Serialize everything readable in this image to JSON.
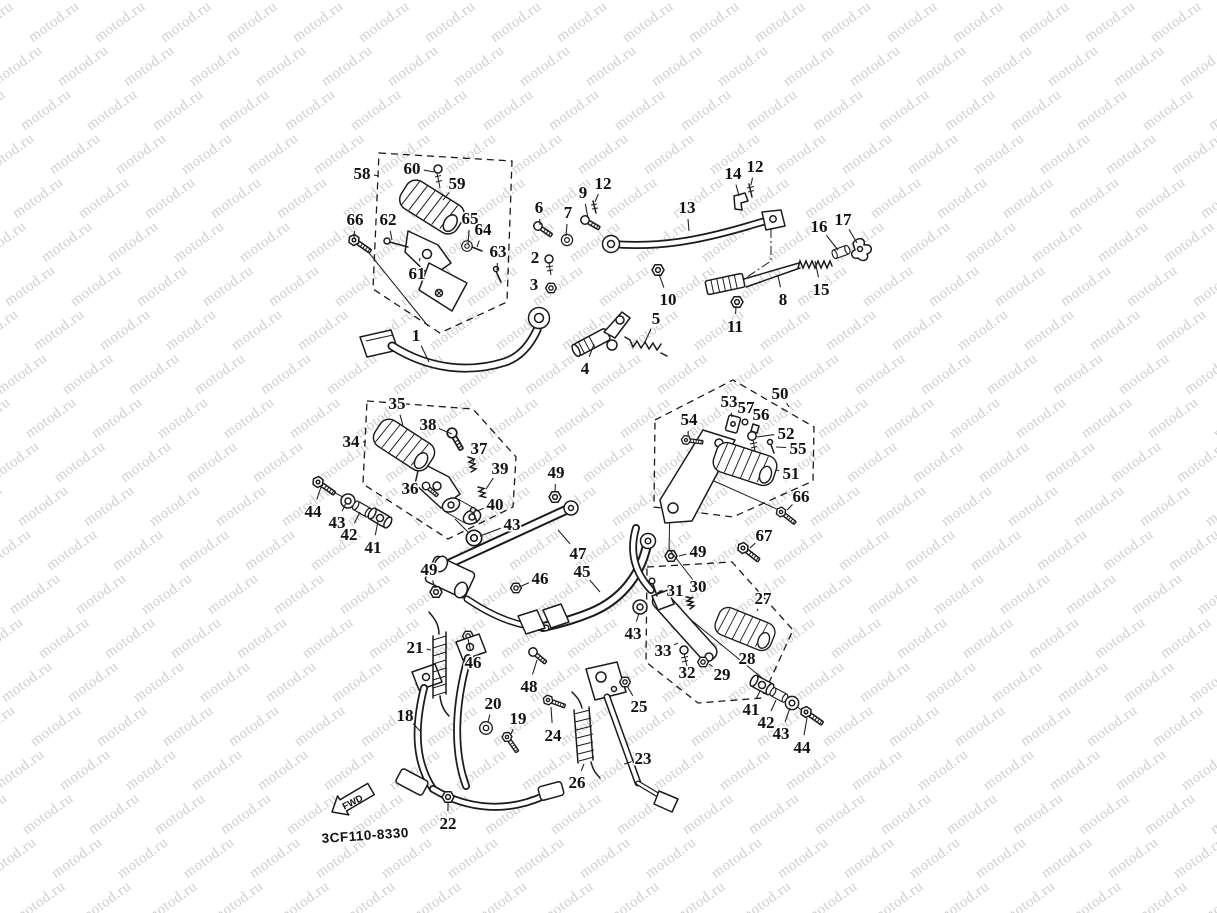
{
  "page": {
    "width": 1217,
    "height": 913,
    "background": "#ffffff"
  },
  "watermark": {
    "text": "motod.ru",
    "color": "#cfcfcf",
    "font_size_px": 15,
    "rotation_deg": -36,
    "col_step_px": 66,
    "row_step_px": 44,
    "row_drift_px": 29
  },
  "diagram": {
    "code": "3CF110-8330",
    "fwd_label": "FWD",
    "line_color": "#1b1b1b",
    "callouts": [
      {
        "label": "58",
        "x": 362,
        "y": 173,
        "tx": 379,
        "ty": 176
      },
      {
        "label": "60",
        "x": 412,
        "y": 168,
        "tx": 434,
        "ty": 172
      },
      {
        "label": "59",
        "x": 457,
        "y": 183,
        "tx": 443,
        "ty": 200
      },
      {
        "label": "66",
        "x": 355,
        "y": 219,
        "tx": 354,
        "ty": 238
      },
      {
        "label": "62",
        "x": 388,
        "y": 219,
        "tx": 392,
        "ty": 240
      },
      {
        "label": "65",
        "x": 470,
        "y": 218,
        "tx": 468,
        "ty": 244
      },
      {
        "label": "64",
        "x": 483,
        "y": 229,
        "tx": 477,
        "ty": 247
      },
      {
        "label": "63",
        "x": 498,
        "y": 251,
        "tx": 497,
        "ty": 270
      },
      {
        "label": "61",
        "x": 417,
        "y": 273,
        "tx": 420,
        "ty": 258
      },
      {
        "label": "6",
        "x": 539,
        "y": 207,
        "tx": 540,
        "ty": 225
      },
      {
        "label": "7",
        "x": 568,
        "y": 212,
        "tx": 566,
        "ty": 236
      },
      {
        "label": "9",
        "x": 583,
        "y": 192,
        "tx": 588,
        "ty": 218
      },
      {
        "label": "12",
        "x": 603,
        "y": 183,
        "tx": 595,
        "ty": 202
      },
      {
        "label": "2",
        "x": 535,
        "y": 257,
        "tx": 547,
        "ty": 262
      },
      {
        "label": "3",
        "x": 534,
        "y": 284,
        "tx": 547,
        "ty": 286
      },
      {
        "label": "1",
        "x": 416,
        "y": 335,
        "tx": 429,
        "ty": 362
      },
      {
        "label": "4",
        "x": 585,
        "y": 368,
        "tx": 594,
        "ty": 344
      },
      {
        "label": "5",
        "x": 656,
        "y": 318,
        "tx": 645,
        "ty": 342
      },
      {
        "label": "10",
        "x": 668,
        "y": 299,
        "tx": 659,
        "ty": 274
      },
      {
        "label": "11",
        "x": 735,
        "y": 326,
        "tx": 736,
        "ty": 306
      },
      {
        "label": "13",
        "x": 687,
        "y": 207,
        "tx": 689,
        "ty": 231
      },
      {
        "label": "14",
        "x": 733,
        "y": 173,
        "tx": 739,
        "ty": 196
      },
      {
        "label": "12",
        "x": 755,
        "y": 166,
        "tx": 751,
        "ty": 185
      },
      {
        "label": "16",
        "x": 819,
        "y": 226,
        "tx": 838,
        "ty": 250
      },
      {
        "label": "17",
        "x": 843,
        "y": 219,
        "tx": 857,
        "ty": 243
      },
      {
        "label": "8",
        "x": 783,
        "y": 299,
        "tx": 778,
        "ty": 276
      },
      {
        "label": "15",
        "x": 821,
        "y": 289,
        "tx": 815,
        "ty": 261
      },
      {
        "label": "34",
        "x": 351,
        "y": 441,
        "tx": 366,
        "ty": 442
      },
      {
        "label": "35",
        "x": 397,
        "y": 403,
        "tx": 403,
        "ty": 426
      },
      {
        "label": "38",
        "x": 428,
        "y": 424,
        "tx": 452,
        "ty": 434
      },
      {
        "label": "37",
        "x": 479,
        "y": 448,
        "tx": 473,
        "ty": 462
      },
      {
        "label": "39",
        "x": 500,
        "y": 468,
        "tx": 486,
        "ty": 489
      },
      {
        "label": "36",
        "x": 410,
        "y": 488,
        "tx": 424,
        "ty": 487
      },
      {
        "label": "40",
        "x": 495,
        "y": 504,
        "tx": 477,
        "ty": 511
      },
      {
        "label": "44",
        "x": 313,
        "y": 511,
        "tx": 321,
        "ty": 487
      },
      {
        "label": "43",
        "x": 337,
        "y": 522,
        "tx": 346,
        "ty": 503
      },
      {
        "label": "42",
        "x": 349,
        "y": 534,
        "tx": 360,
        "ty": 512
      },
      {
        "label": "41",
        "x": 373,
        "y": 547,
        "tx": 378,
        "ty": 521
      },
      {
        "label": "43",
        "x": 512,
        "y": 524,
        "tx": 480,
        "ty": 536
      },
      {
        "label": "49",
        "x": 556,
        "y": 472,
        "tx": 555,
        "ty": 492
      },
      {
        "label": "47",
        "x": 578,
        "y": 553,
        "tx": 558,
        "ty": 530
      },
      {
        "label": "45",
        "x": 582,
        "y": 571,
        "tx": 600,
        "ty": 592
      },
      {
        "label": "46",
        "x": 540,
        "y": 578,
        "tx": 519,
        "ty": 587
      },
      {
        "label": "49",
        "x": 429,
        "y": 569,
        "tx": 435,
        "ty": 588
      },
      {
        "label": "46",
        "x": 473,
        "y": 662,
        "tx": 468,
        "ty": 639
      },
      {
        "label": "48",
        "x": 529,
        "y": 686,
        "tx": 537,
        "ty": 660
      },
      {
        "label": "21",
        "x": 415,
        "y": 647,
        "tx": 431,
        "ty": 650
      },
      {
        "label": "18",
        "x": 405,
        "y": 715,
        "tx": 420,
        "ty": 731
      },
      {
        "label": "20",
        "x": 493,
        "y": 703,
        "tx": 488,
        "ty": 722
      },
      {
        "label": "19",
        "x": 518,
        "y": 718,
        "tx": 511,
        "ty": 734
      },
      {
        "label": "22",
        "x": 448,
        "y": 823,
        "tx": 448,
        "ty": 803
      },
      {
        "label": "24",
        "x": 553,
        "y": 735,
        "tx": 551,
        "ty": 707
      },
      {
        "label": "26",
        "x": 577,
        "y": 782,
        "tx": 584,
        "ty": 764
      },
      {
        "label": "23",
        "x": 643,
        "y": 758,
        "tx": 624,
        "ty": 764
      },
      {
        "label": "25",
        "x": 639,
        "y": 706,
        "tx": 627,
        "ty": 686
      },
      {
        "label": "50",
        "x": 780,
        "y": 393,
        "tx": 789,
        "ty": 407
      },
      {
        "label": "53",
        "x": 729,
        "y": 401,
        "tx": 732,
        "ty": 417
      },
      {
        "label": "57",
        "x": 746,
        "y": 407,
        "tx": 745,
        "ty": 420
      },
      {
        "label": "56",
        "x": 761,
        "y": 414,
        "tx": 756,
        "ty": 424
      },
      {
        "label": "54",
        "x": 689,
        "y": 419,
        "tx": 688,
        "ty": 436
      },
      {
        "label": "52",
        "x": 786,
        "y": 433,
        "tx": 757,
        "ty": 437
      },
      {
        "label": "55",
        "x": 798,
        "y": 448,
        "tx": 776,
        "ty": 447
      },
      {
        "label": "51",
        "x": 791,
        "y": 473,
        "tx": 776,
        "ty": 470
      },
      {
        "label": "66",
        "x": 801,
        "y": 496,
        "tx": 787,
        "ty": 510
      },
      {
        "label": "67",
        "x": 764,
        "y": 535,
        "tx": 750,
        "ty": 548
      },
      {
        "label": "49",
        "x": 698,
        "y": 551,
        "tx": 679,
        "ty": 556
      },
      {
        "label": "30",
        "x": 698,
        "y": 586,
        "tx": 692,
        "ty": 598
      },
      {
        "label": "31",
        "x": 675,
        "y": 590,
        "tx": 659,
        "ty": 591
      },
      {
        "label": "27",
        "x": 763,
        "y": 598,
        "tx": 757,
        "ty": 611
      },
      {
        "label": "28",
        "x": 747,
        "y": 658,
        "tx": 744,
        "ty": 647
      },
      {
        "label": "33",
        "x": 663,
        "y": 650,
        "tx": 678,
        "ty": 643
      },
      {
        "label": "32",
        "x": 687,
        "y": 672,
        "tx": 686,
        "ty": 662
      },
      {
        "label": "29",
        "x": 722,
        "y": 674,
        "tx": 709,
        "ty": 664
      },
      {
        "label": "43",
        "x": 633,
        "y": 633,
        "tx": 639,
        "ty": 613
      },
      {
        "label": "41",
        "x": 751,
        "y": 709,
        "tx": 760,
        "ty": 691
      },
      {
        "label": "42",
        "x": 766,
        "y": 722,
        "tx": 776,
        "ty": 700
      },
      {
        "label": "43",
        "x": 781,
        "y": 733,
        "tx": 790,
        "ty": 708
      },
      {
        "label": "44",
        "x": 802,
        "y": 747,
        "tx": 807,
        "ty": 718
      }
    ]
  }
}
